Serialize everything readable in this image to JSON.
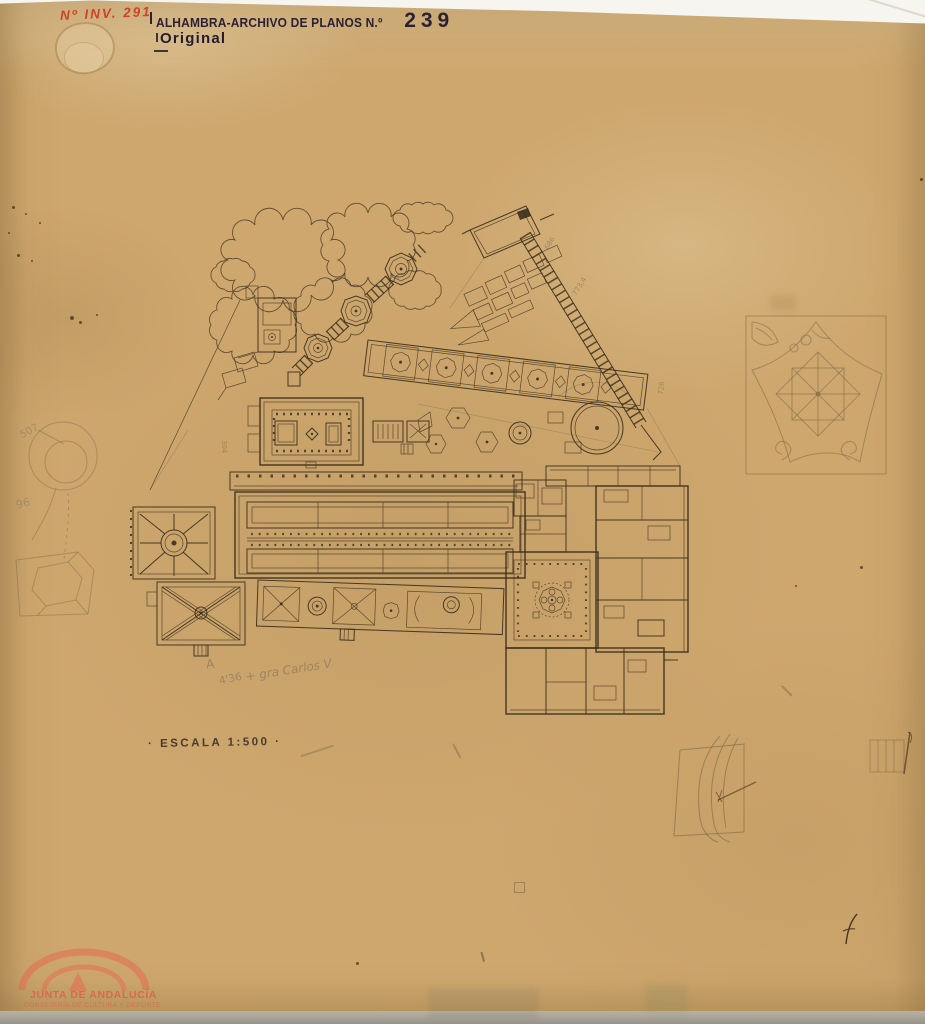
{
  "document": {
    "inventory_number": "Nº INV. 291",
    "archive_stamp_prefix": "ALHAMBRA-ARCHIVO DE PLANOS N.º",
    "archive_plan_number": "239",
    "original_stamp": "Original",
    "scale_stamp": "· ESCALA 1:500 ·"
  },
  "pencil_notes": {
    "letter": "A",
    "measure": "4'36",
    "phrase": "+ gra Carlos V",
    "margin_circle_number": "507",
    "margin_number": "96"
  },
  "plan_pencil_marks": [
    {
      "text": "686"
    },
    {
      "text": "773,4"
    },
    {
      "text": "726"
    },
    {
      "text": "304"
    }
  ],
  "watermark": {
    "line1": "JUNTA DE ANDALUCÍA",
    "line2": "CONSEJERÍA DE CULTURA Y DEPORTE"
  },
  "colors": {
    "paper": "#cda76e",
    "plan_ink": "#3c2f1c",
    "stamp_ink": "#2b2133",
    "red_ink": "#cf3a1c",
    "pencil": "#8d7c5f",
    "watermark_red": "#e0654e",
    "scan_background": "#f7f5ef"
  }
}
